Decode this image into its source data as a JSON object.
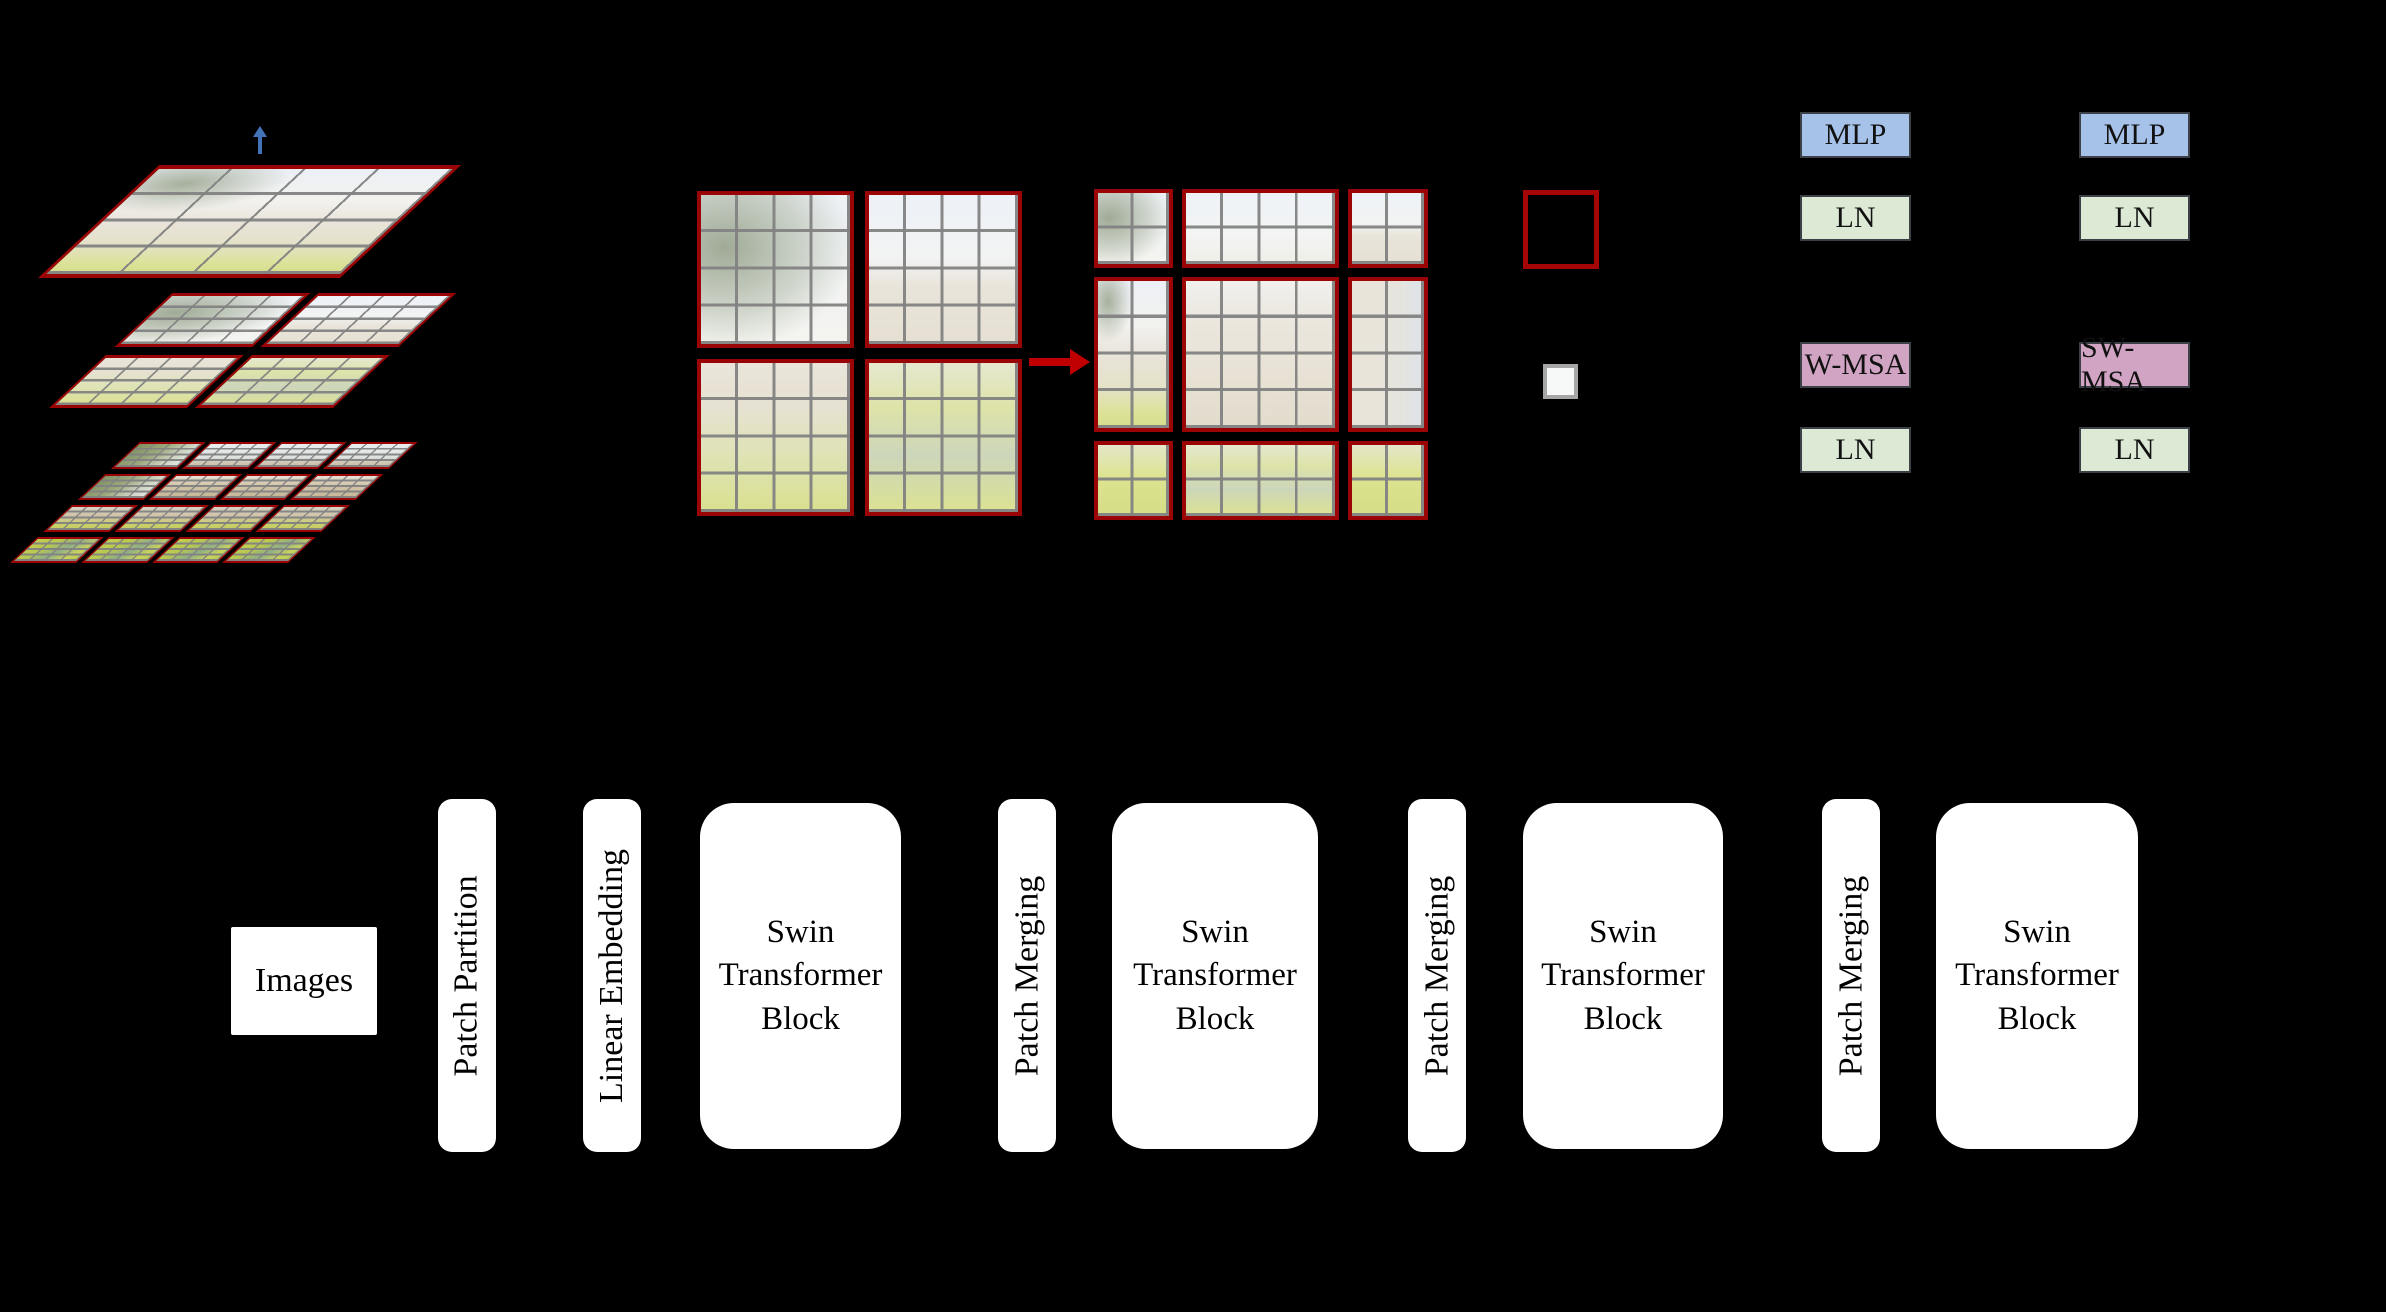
{
  "figure": {
    "background": "#000000",
    "hierarchy_stack": {
      "up_arrow_color": "#4273b8",
      "layers": [
        {
          "windows": 1,
          "cells_per_window": 16
        },
        {
          "windows": 4,
          "cells_per_window": 16
        },
        {
          "windows": 16,
          "cells_per_window": 16
        }
      ]
    },
    "window_partition": {
      "left_grid_windows": 4,
      "right_grid_windows": 9,
      "cells_per_window": 16,
      "shift_arrow_color": "#c00000",
      "window_border_color": "#9a0404"
    },
    "legend": {
      "window_swatch": "red window outline",
      "patch_swatch": "gray patch square",
      "window_swatch_color": "#a50505",
      "patch_swatch_border": "#a6a6a6"
    }
  },
  "transformer_block": {
    "left": {
      "mlp": "MLP",
      "ln_top": "LN",
      "msa": "W-MSA",
      "ln_bottom": "LN"
    },
    "right": {
      "mlp": "MLP",
      "ln_top": "LN",
      "msa": "SW-MSA",
      "ln_bottom": "LN"
    },
    "colors": {
      "mlp_fill": "#a6c2e9",
      "ln_fill": "#dcead5",
      "msa_fill": "#d1a4c3"
    }
  },
  "pipeline": {
    "input_label": "Images",
    "stages": [
      {
        "label": "Patch Partition"
      },
      {
        "label": "Linear Embedding"
      },
      {
        "label": "Swin Transformer Block"
      },
      {
        "label": "Patch Merging"
      },
      {
        "label": "Swin Transformer Block"
      },
      {
        "label": "Patch Merging"
      },
      {
        "label": "Swin Transformer Block"
      },
      {
        "label": "Patch Merging"
      },
      {
        "label": "Swin Transformer Block"
      }
    ],
    "swin_block_lines": "Swin\nTransformer\nBlock"
  }
}
